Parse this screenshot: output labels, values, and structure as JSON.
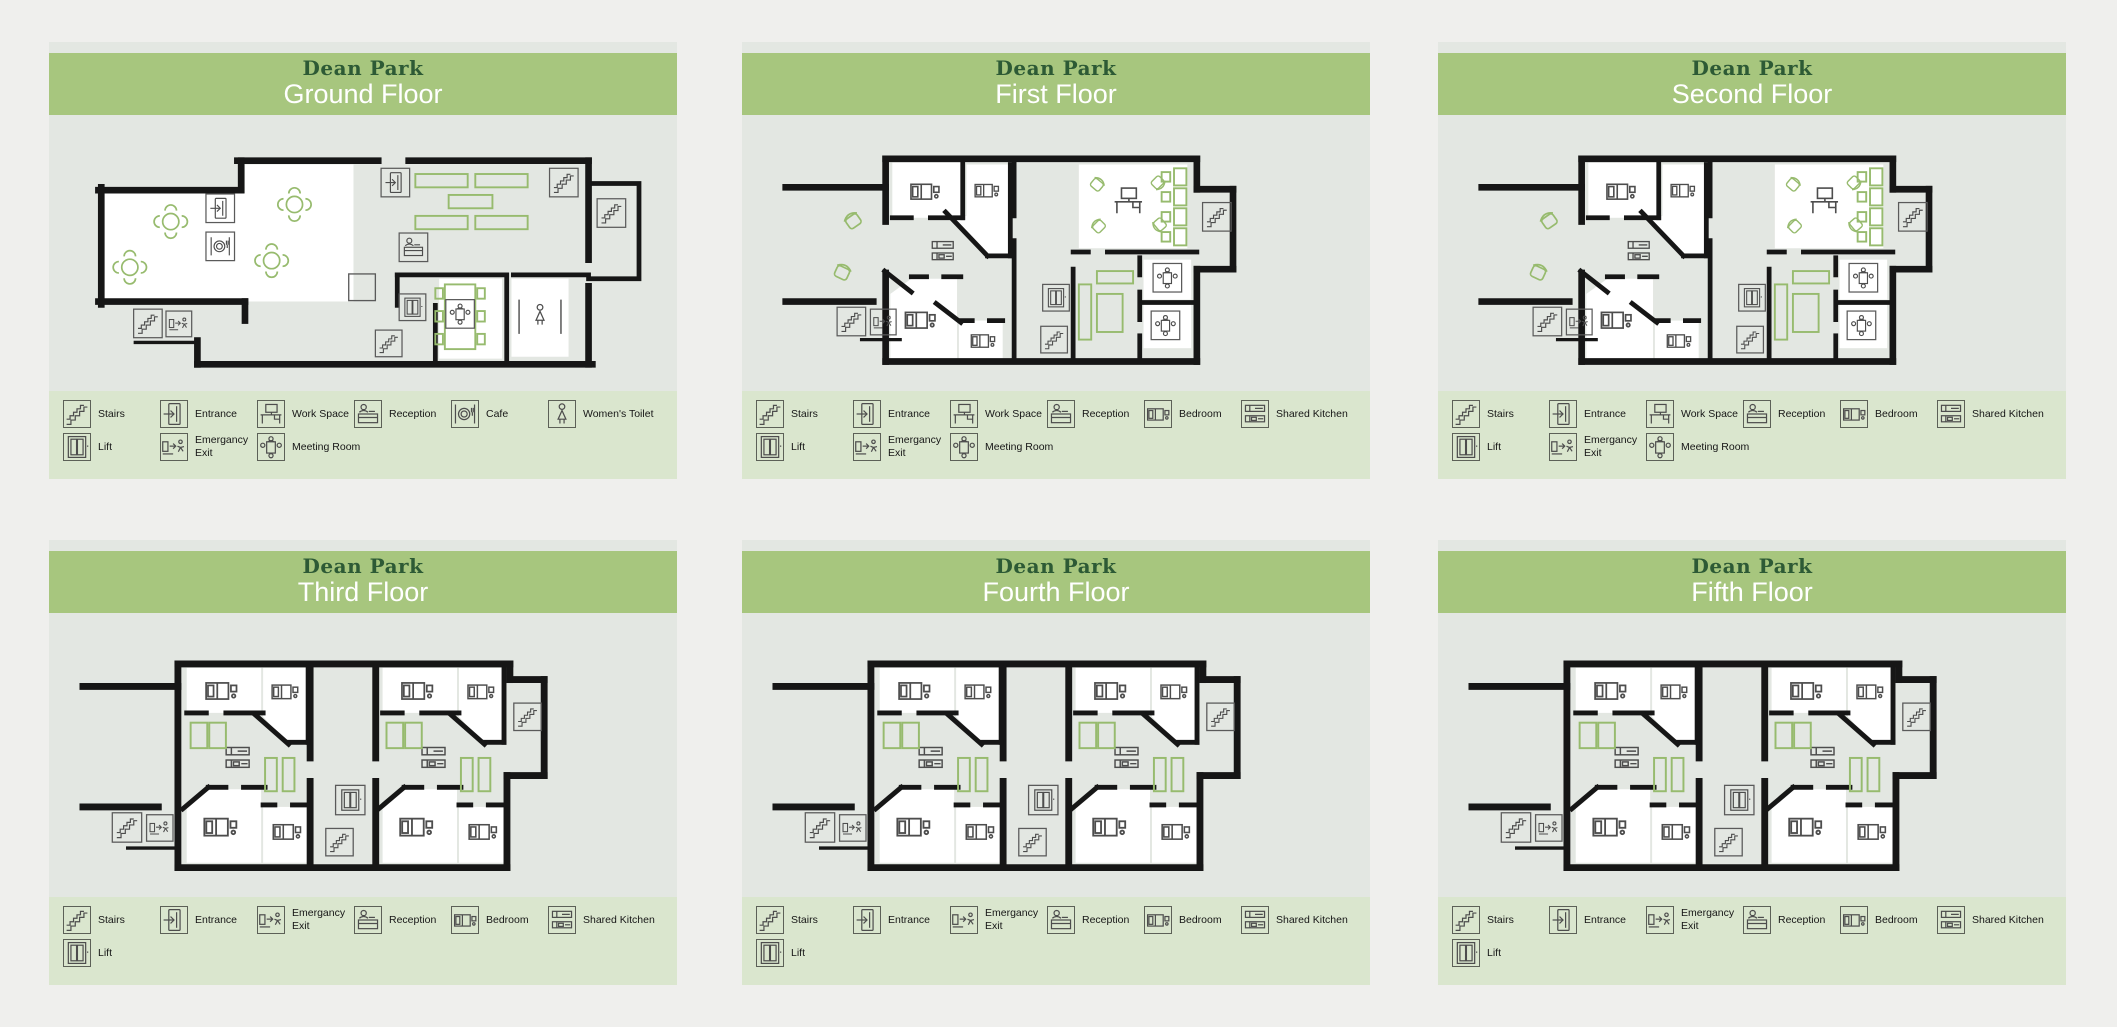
{
  "colors": {
    "page_bg": "#efefed",
    "panel_bg": "#e3e7e2",
    "header_green": "#a7c67e",
    "legend_green": "#dae6ce",
    "brand_green": "#2d5a35",
    "wall_black": "#161616",
    "furniture_green": "#97bb6e",
    "icon_gray": "#4d4d4d"
  },
  "panels": [
    {
      "brand": "Dean Park",
      "title": "Ground Floor",
      "plan": "ground",
      "legend": [
        [
          {
            "icon": "stairs",
            "label": "Stairs"
          },
          {
            "icon": "entrance",
            "label": "Entrance"
          },
          {
            "icon": "workspace",
            "label": "Work Space"
          },
          {
            "icon": "reception",
            "label": "Reception"
          },
          {
            "icon": "cafe",
            "label": "Cafe"
          },
          {
            "icon": "toilet",
            "label": "Women's Toilet"
          }
        ],
        [
          {
            "icon": "lift",
            "label": "Lift"
          },
          {
            "icon": "exit",
            "label": "Emergancy\nExit"
          },
          {
            "icon": "meeting",
            "label": "Meeting Room"
          }
        ]
      ]
    },
    {
      "brand": "Dean Park",
      "title": "First Floor",
      "plan": "office",
      "legend": [
        [
          {
            "icon": "stairs",
            "label": "Stairs"
          },
          {
            "icon": "entrance",
            "label": "Entrance"
          },
          {
            "icon": "workspace",
            "label": "Work Space"
          },
          {
            "icon": "reception",
            "label": "Reception"
          },
          {
            "icon": "bed",
            "label": "Bedroom"
          },
          {
            "icon": "kitchen",
            "label": "Shared Kitchen"
          }
        ],
        [
          {
            "icon": "lift",
            "label": "Lift"
          },
          {
            "icon": "exit",
            "label": "Emergancy\nExit"
          },
          {
            "icon": "meeting",
            "label": "Meeting Room"
          }
        ]
      ]
    },
    {
      "brand": "Dean Park",
      "title": "Second Floor",
      "plan": "office",
      "legend": [
        [
          {
            "icon": "stairs",
            "label": "Stairs"
          },
          {
            "icon": "entrance",
            "label": "Entrance"
          },
          {
            "icon": "workspace",
            "label": "Work Space"
          },
          {
            "icon": "reception",
            "label": "Reception"
          },
          {
            "icon": "bed",
            "label": "Bedroom"
          },
          {
            "icon": "kitchen",
            "label": "Shared Kitchen"
          }
        ],
        [
          {
            "icon": "lift",
            "label": "Lift"
          },
          {
            "icon": "exit",
            "label": "Emergancy\nExit"
          },
          {
            "icon": "meeting",
            "label": "Meeting Room"
          }
        ]
      ]
    },
    {
      "brand": "Dean Park",
      "title": "Third Floor",
      "plan": "residential",
      "legend": [
        [
          {
            "icon": "stairs",
            "label": "Stairs"
          },
          {
            "icon": "entrance",
            "label": "Entrance"
          },
          {
            "icon": "exit",
            "label": "Emergancy\nExit"
          },
          {
            "icon": "reception",
            "label": "Reception"
          },
          {
            "icon": "bed",
            "label": "Bedroom"
          },
          {
            "icon": "kitchen",
            "label": "Shared Kitchen"
          }
        ],
        [
          {
            "icon": "lift",
            "label": "Lift"
          }
        ]
      ]
    },
    {
      "brand": "Dean Park",
      "title": "Fourth Floor",
      "plan": "residential",
      "legend": [
        [
          {
            "icon": "stairs",
            "label": "Stairs"
          },
          {
            "icon": "entrance",
            "label": "Entrance"
          },
          {
            "icon": "exit",
            "label": "Emergancy\nExit"
          },
          {
            "icon": "reception",
            "label": "Reception"
          },
          {
            "icon": "bed",
            "label": "Bedroom"
          },
          {
            "icon": "kitchen",
            "label": "Shared Kitchen"
          }
        ],
        [
          {
            "icon": "lift",
            "label": "Lift"
          }
        ]
      ]
    },
    {
      "brand": "Dean Park",
      "title": "Fifth Floor",
      "plan": "residential",
      "legend": [
        [
          {
            "icon": "stairs",
            "label": "Stairs"
          },
          {
            "icon": "entrance",
            "label": "Entrance"
          },
          {
            "icon": "exit",
            "label": "Emergancy\nExit"
          },
          {
            "icon": "reception",
            "label": "Reception"
          },
          {
            "icon": "bed",
            "label": "Bedroom"
          },
          {
            "icon": "kitchen",
            "label": "Shared Kitchen"
          }
        ],
        [
          {
            "icon": "lift",
            "label": "Lift"
          }
        ]
      ]
    }
  ]
}
